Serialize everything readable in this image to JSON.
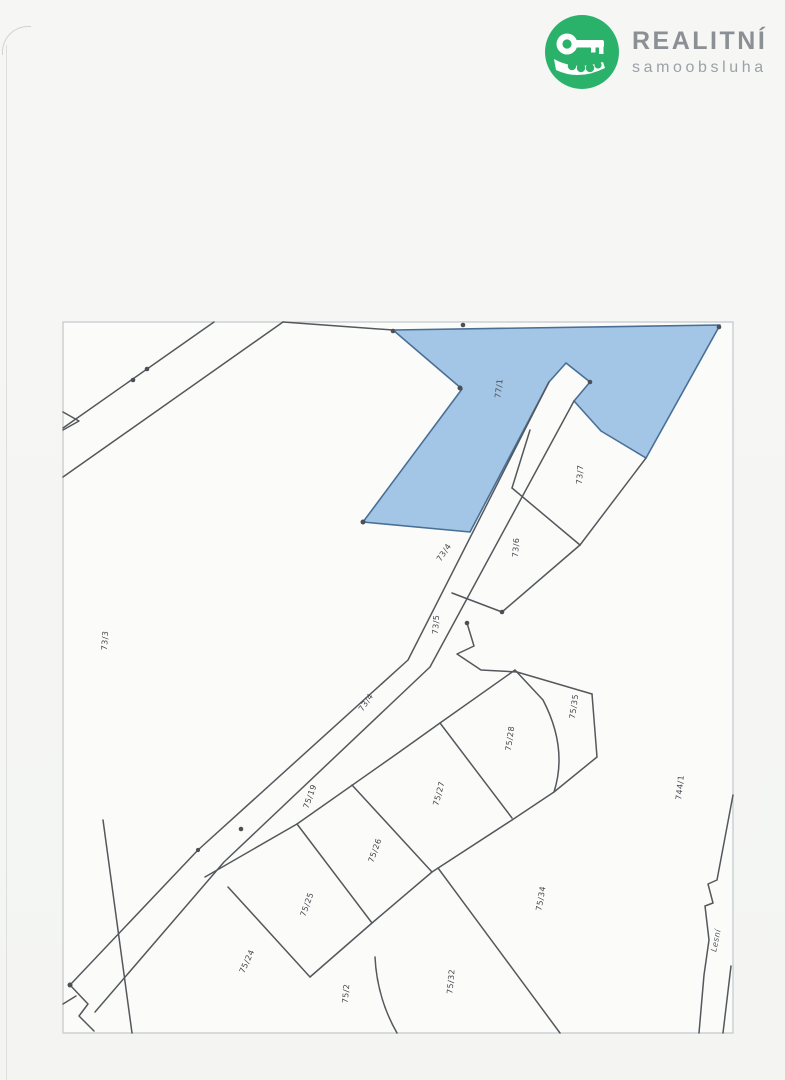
{
  "brand": {
    "title": "REALITNÍ",
    "subtitle": "samoobsluha",
    "logo_color": "#2bb26a",
    "icon": "crocodile-key-logo"
  },
  "map": {
    "type": "cadastral-parcel-map",
    "colors": {
      "highlight_fill": "#a3c6e6",
      "highlight_stroke": "#4a6f96",
      "boundary_line": "#54575c",
      "frame": "#c3c7ca"
    },
    "highlighted_parcel": "77/1",
    "parcel_labels": [
      {
        "label": "77/1"
      },
      {
        "label": "73/7"
      },
      {
        "label": "73/6"
      },
      {
        "label": "73/5"
      },
      {
        "label": "73/4"
      },
      {
        "label": "73/4"
      },
      {
        "label": "73/3"
      },
      {
        "label": "75/19"
      },
      {
        "label": "75/28"
      },
      {
        "label": "75/35"
      },
      {
        "label": "75/27"
      },
      {
        "label": "75/26"
      },
      {
        "label": "75/25"
      },
      {
        "label": "75/24"
      },
      {
        "label": "75/34"
      },
      {
        "label": "75/32"
      },
      {
        "label": "75/2"
      },
      {
        "label": "744/1"
      }
    ],
    "street_label": {
      "label": "Lesní"
    }
  }
}
